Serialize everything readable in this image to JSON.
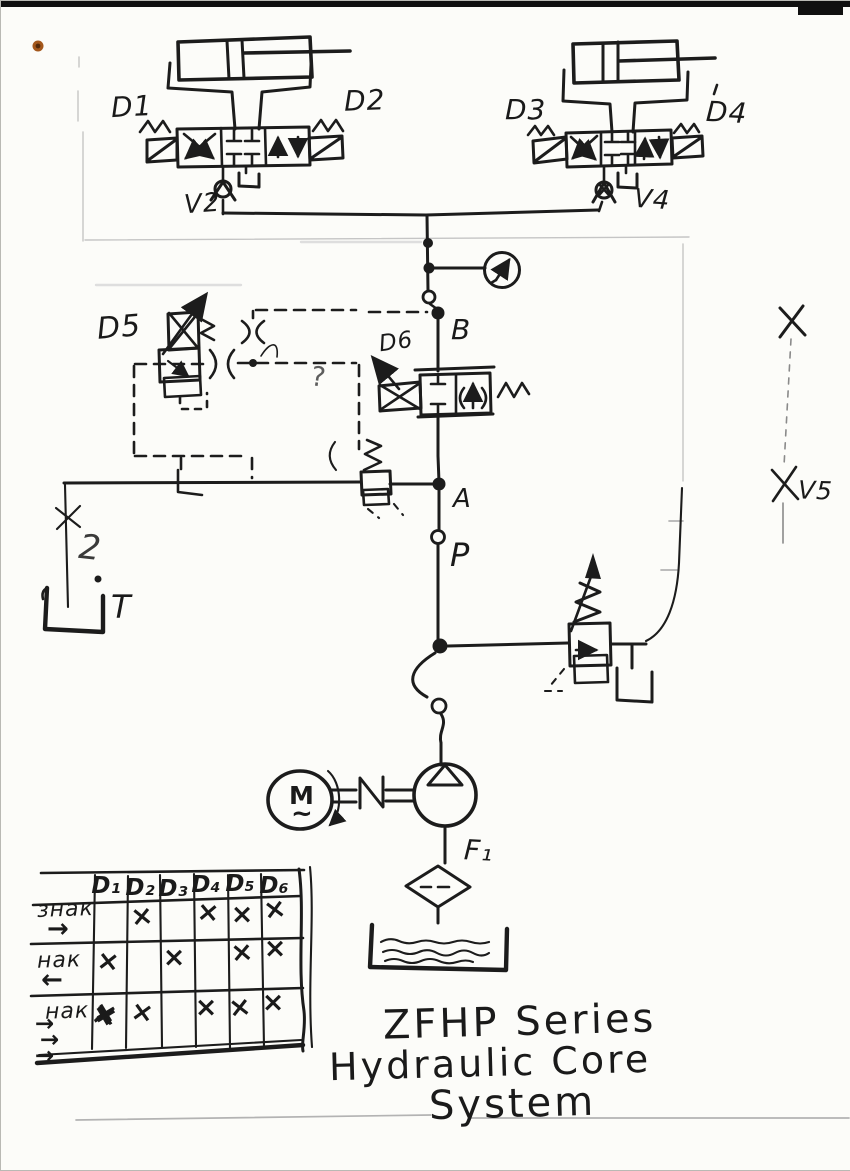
{
  "title_block": {
    "line1": "ZFHP Series",
    "line2": "Hydraulic Core",
    "line3": "System"
  },
  "labels": {
    "d1": "D1",
    "d2": "D2",
    "d3": "D3",
    "d4": "D4",
    "d5": "D5",
    "d6": "D6",
    "v2": "V2",
    "v4": "V4",
    "v5": "V5",
    "a": "A",
    "b": "B",
    "p": "P",
    "t": "T",
    "two": "2",
    "f1": "F₁",
    "motor_m": "M",
    "motor_wave": "~",
    "question": "?"
  },
  "truth_table": {
    "columns": [
      "D₁",
      "D₂",
      "D₃",
      "D₄",
      "D₅",
      "D₆"
    ],
    "rows": [
      {
        "label": "знак",
        "arrows": [
          "→"
        ],
        "marks": [
          "",
          "×",
          "",
          "×",
          "×",
          "×"
        ]
      },
      {
        "label": "нак",
        "arrows": [
          "←"
        ],
        "marks": [
          "×",
          "",
          "×",
          "",
          "×",
          "×"
        ]
      },
      {
        "label": "нак",
        "arrows": [
          "→",
          "→",
          "→"
        ],
        "marks": [
          "×",
          "×",
          "",
          "×",
          "×",
          "×"
        ]
      }
    ]
  },
  "colors": {
    "ink": "#1c1c1c",
    "pencil": "#c5c5c5",
    "paper": "#fcfcf9",
    "accent_dot": "#a3571c"
  }
}
